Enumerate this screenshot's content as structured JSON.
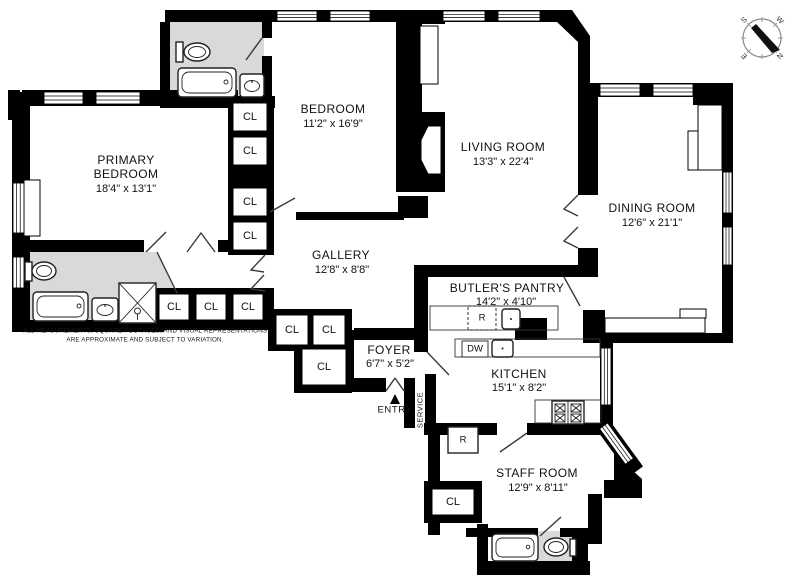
{
  "rooms": {
    "primary_bedroom": {
      "line1": "PRIMARY",
      "line2": "BEDROOM",
      "dims": "18'4\" x 13'1\""
    },
    "bedroom": {
      "name": "BEDROOM",
      "dims": "11'2\" x 16'9\""
    },
    "living_room": {
      "name": "LIVING ROOM",
      "dims": "13'3\" x 22'4\""
    },
    "dining_room": {
      "name": "DINING ROOM",
      "dims": "12'6\" x 21'1\""
    },
    "gallery": {
      "name": "GALLERY",
      "dims": "12'8\" x 8'8\""
    },
    "butlers_pantry": {
      "name": "BUTLER'S PANTRY",
      "dims": "14'2\" x 4'10\""
    },
    "foyer": {
      "name": "FOYER",
      "dims": "6'7\" x 5'2\""
    },
    "kitchen": {
      "name": "KITCHEN",
      "dims": "15'1\" x 8'2\""
    },
    "staff_room": {
      "name": "STAFF ROOM",
      "dims": "12'9\" x 8'11\""
    }
  },
  "labels": {
    "closet": "CL",
    "refrigerator": "R",
    "dishwasher": "DW",
    "entry": "ENTRY",
    "service": "SERVICE"
  },
  "compass": {
    "north": "N",
    "south": "S",
    "east": "E",
    "west": "W"
  },
  "disclaimer": {
    "line1": "ALL MEASUREMENTS, SQUARE FOOTAGES, AND VISUAL REPRESENTATIONS",
    "line2": "ARE APPROXIMATE AND SUBJECT TO VARIATION."
  },
  "colors": {
    "wall": "#000000",
    "bathroom_fill": "#d9d9d9",
    "background": "#ffffff",
    "door_line": "#3a3a3a"
  }
}
